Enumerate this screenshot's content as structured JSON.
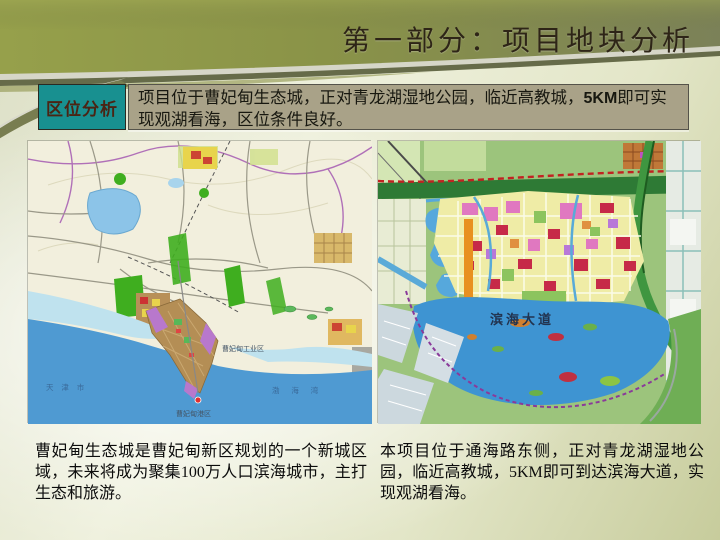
{
  "slide": {
    "title": "第一部分：项目地块分析"
  },
  "location_analysis": {
    "label": "区位分析",
    "description": {
      "before_bold": "项目位于曹妃甸生态城，正对青龙湖湿地公园，临近高教城，",
      "bold": "5KM",
      "after_bold": "即可实现观湖看海，区位条件良好。"
    }
  },
  "maps": {
    "left": {
      "name": "caofeidian-regional-map",
      "labels": {
        "tianjin": "天 津 市",
        "bohai_bay": "渤  海  湾",
        "industrial_zone": "曹妃甸工业区",
        "port_zone": "曹妃甸港区"
      },
      "caption": "曹妃甸生态城是曹妃甸新区规划的一个新城区域，未来将成为聚集100万人口滨海城市，主打生态和旅游。"
    },
    "right": {
      "name": "eco-city-planning-map",
      "labels": {
        "binhai_avenue": "滨海大道"
      },
      "caption": "本项目位于通海路东侧，正对青龙湖湿地公园，临近高教城，5KM即可到达滨海大道，实现观湖看海。"
    }
  },
  "colors": {
    "banner_olive": "#8e9845",
    "banner_sage": "#7b8158",
    "label_teal": "#189090",
    "desc_box_tan": "#a9a288",
    "sea_blue": "#4f9ad2",
    "lake_blue": "#3e94d2",
    "title_text": "#2e2517"
  }
}
